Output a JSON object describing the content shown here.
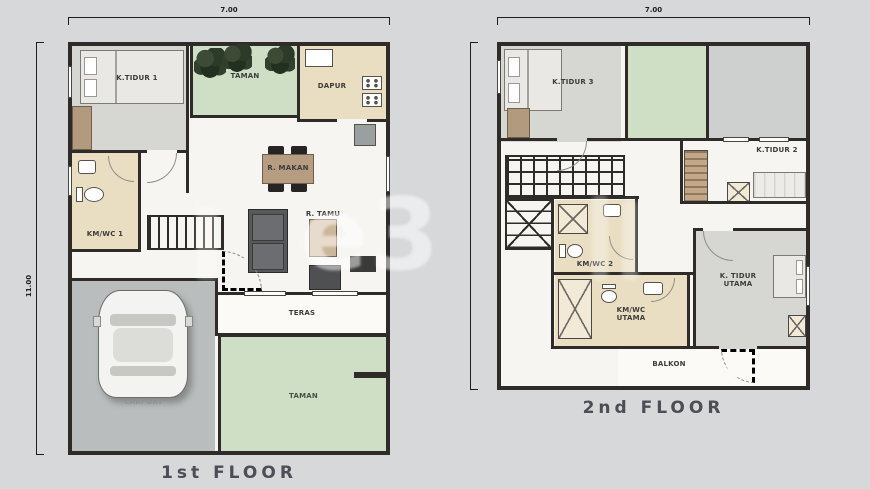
{
  "titles": {
    "floor1": "1st FLOOR",
    "floor2": "2nd FLOOR"
  },
  "dimensions": {
    "floor1_width": "7.00",
    "floor2_width": "7.00",
    "floor1_height": "11.00"
  },
  "floor1": {
    "bedroom1": "K.TIDUR 1",
    "garden_top": "TAMAN",
    "kitchen": "DAPUR",
    "dining": "R. MAKAN",
    "living": "R. TAMU",
    "bathroom": "KM/WC 1",
    "terrace": "TERAS",
    "carport": "CARPORT",
    "garden_bottom": "TAMAN"
  },
  "floor2": {
    "bedroom3": "K.TIDUR 3",
    "bedroom2": "K.TIDUR 2",
    "bathroom2": "KM/WC 2",
    "master_bathroom": "KM/WC UTAMA",
    "master_bedroom": "K. TIDUR UTAMA",
    "balcony": "BALKON"
  },
  "watermark": "e3",
  "colors": {
    "wall": "#2e2b28",
    "green": "#cfdfc6",
    "tan": "#e9dec2",
    "room_gray": "#d6d6d2",
    "carport_gray": "#b9bdbd"
  }
}
